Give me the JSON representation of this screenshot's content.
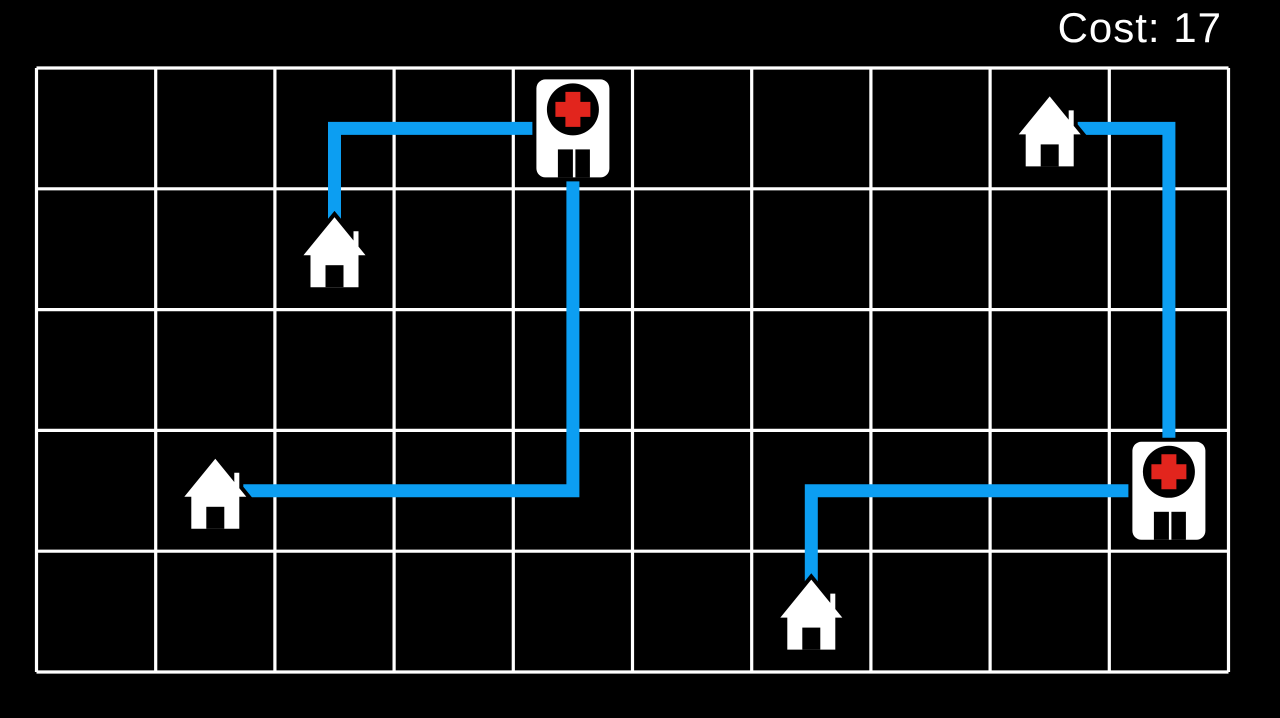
{
  "hud": {
    "cost_label": "Cost: 17"
  },
  "board": {
    "columns": 10,
    "rows": 5,
    "grid_color": "#ffffff",
    "background_color": "#000000",
    "path_color": "#0c9ef2",
    "cross_color": "#e2251d",
    "building_fill": "#ffffff",
    "outline_color": "#000000"
  },
  "entities": [
    {
      "id": "hospital-1",
      "type": "hospital",
      "col": 4,
      "row": 0
    },
    {
      "id": "hospital-2",
      "type": "hospital",
      "col": 9,
      "row": 3
    },
    {
      "id": "house-1",
      "type": "house",
      "col": 2,
      "row": 1
    },
    {
      "id": "house-2",
      "type": "house",
      "col": 1,
      "row": 3
    },
    {
      "id": "house-3",
      "type": "house",
      "col": 6,
      "row": 4
    },
    {
      "id": "house-4",
      "type": "house",
      "col": 8,
      "row": 0
    }
  ],
  "paths": [
    {
      "id": "road-house1-hospital1",
      "from": "house-1",
      "to": "hospital-1",
      "cells": [
        [
          2,
          1
        ],
        [
          2,
          0
        ],
        [
          4,
          0
        ]
      ],
      "length": 3
    },
    {
      "id": "road-hospital1-house2",
      "from": "hospital-1",
      "to": "house-2",
      "cells": [
        [
          4,
          0
        ],
        [
          4,
          3
        ],
        [
          1,
          3
        ]
      ],
      "length": 6
    },
    {
      "id": "road-house4-hospital2",
      "from": "house-4",
      "to": "hospital-2",
      "cells": [
        [
          8,
          0
        ],
        [
          9,
          0
        ],
        [
          9,
          3
        ]
      ],
      "length": 4
    },
    {
      "id": "road-house3-hospital2",
      "from": "house-3",
      "to": "hospital-2",
      "cells": [
        [
          6,
          4
        ],
        [
          6,
          3
        ],
        [
          9,
          3
        ]
      ],
      "length": 4
    }
  ]
}
